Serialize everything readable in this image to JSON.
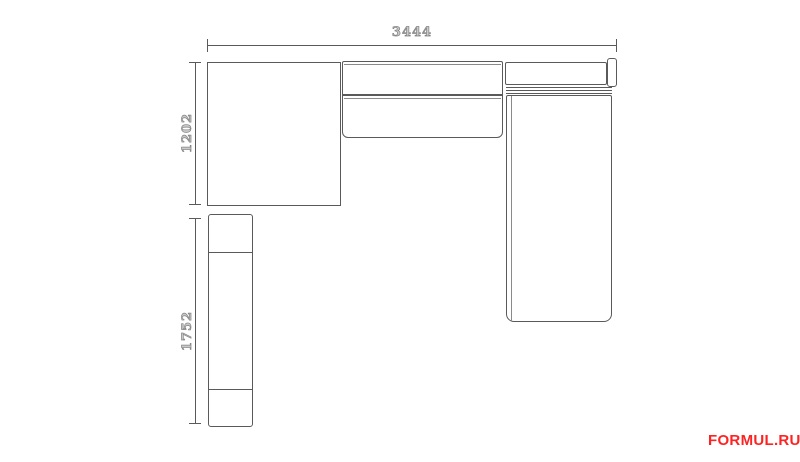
{
  "title": "corner-sofa-plan-drawing",
  "dimensions": {
    "top_width": "3444",
    "left_depth_upper": "1202",
    "left_depth_lower": "1752"
  },
  "colors": {
    "line": "#5a5a5a",
    "dim_text": "#838383",
    "watermark": "#ff2222",
    "background": "#ffffff"
  },
  "watermark": {
    "text": "FORMUL.RU"
  }
}
